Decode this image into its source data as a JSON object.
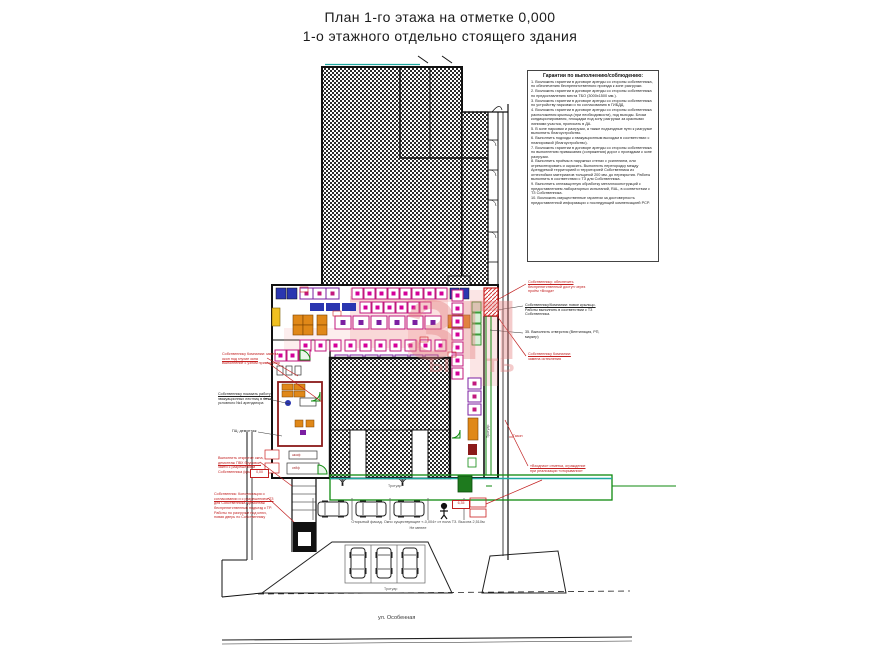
{
  "title": {
    "line1": "План 1-го этажа на отметке 0,000",
    "line2": "1-о этажного отдельно стоящего здания"
  },
  "notes": {
    "title": "Гарантии по выполнению/соблюдению:",
    "items": [
      "1. Возложить гарантии в договоре аренды со стороны собственника, по обеспечению беспрепятственного проезда к зоне разгрузки.",
      "2. Возложить гарантии в договоре аренды со стороны собственника по предоставлению места ТБО (3000х1500 мм.).",
      "3. Возложить гарантии в договоре аренды со стороны собственника по устройству парковки и по согласованию в ГИБДД.",
      "4. Возложить гарантии в договоре аренды со стороны собственника расположения крыльца (при необходимости), под выходы. Блоки кондиционирования, площадки под зону разгрузки за красными линиями участка, прописать в ДА.",
      "5. В зоне парковки и разгрузки, а также подъездные пути к разгрузке выполнить благоустройство.",
      "6. Выполнить подходы к эвакуационным выходам в соответствии с планировкой (благоустройство).",
      "7. Возложить гарантии в договоре аренды со стороны собственника по выполнению примыкания (сопряжения) дорог с проездами к зоне разгрузки.",
      "8. Выполнить проёмы в наружных стенах с усилением, или отремонтировать и окрасить. Выполнить перегородку между Арендуемой территорией и территорией Собственника из огнестойких материалов толщиной 200 мм. до перекрытия. Работы выполнить в соответствии с ТЗ для Собственника.",
      "9. Выполнить огнезащитную обработку металлоконструкций с предоставлением лабораторных испытаний, RAL, в соответствии с ТЗ Собственника.",
      "10. Возложить имущественные гарантии за достоверность предоставленной информации с последующей компенсацией РСР."
    ]
  },
  "annotations": {
    "r1": [
      "Собственнику: обеспечить",
      "беспрепятственный доступ через",
      "проём «Входа»"
    ],
    "r2": [
      "Собственнику/Компании: новое крыльцо.",
      "Работы выполнить в соответствии с ТЗ",
      "Собственника."
    ],
    "r3": [
      "35. Выполнить отверстия (Вентиляция, РП,",
      "маркер)"
    ],
    "r4": [
      "Собственнику Компании:",
      "замена остекления"
    ],
    "r6": [
      "«Входная» отметка, ограждение",
      "при реализации «открывания»"
    ],
    "l1": [
      "Собственнику Компании: замена",
      "окон под глухие окна",
      "Выполнение с узлом примыкания"
    ],
    "l2": [
      "Собственнику показать работу",
      "эвакуационных лестниц в месте",
      "условного №4 арендатора"
    ],
    "l3": [
      "ГЩ: демонтаж"
    ],
    "l4": [
      "Выполнить открытие окна,",
      "демонтаж ПВХ брусовки,",
      "зайти с разрешением",
      "Собственника (крыльцо)"
    ],
    "l5": [
      "Собственник: Консультация о",
      "согласовании и с разрешением ТЗ",
      "для Собственника. Демонтаж",
      "беспрепятственный подъезд к ТР.",
      "Работы по разгрузке под ключ,",
      "новая дверь по Собственнику"
    ]
  },
  "labels": {
    "trotuar_strip": "Тротуар",
    "trotuar_island": "Тротуар",
    "trotuar_side": "Тротуар",
    "street": "ул. Особенная",
    "gazon": "Газон",
    "facade1": "Открытый фасад. Окно существующее «-0,004» от пола ТЗ. Высота 2,510м",
    "facade2": "Не менее",
    "dim1": "0,00",
    "dim2": "6,35",
    "cab1": "шкаф",
    "cab2": "сейф"
  },
  "watermark": {
    "big": "ЗП",
    "frag1": "ы",
    "frag2": "ть"
  },
  "colors": {
    "magenta": "#c2187e",
    "purple": "#7b1fa2",
    "orange": "#e08818",
    "green": "#0f8a0f",
    "teal": "#1fa8a0",
    "annotation_red": "#c22020",
    "maroon": "#8b1a1a",
    "blue": "#2a36b0"
  }
}
